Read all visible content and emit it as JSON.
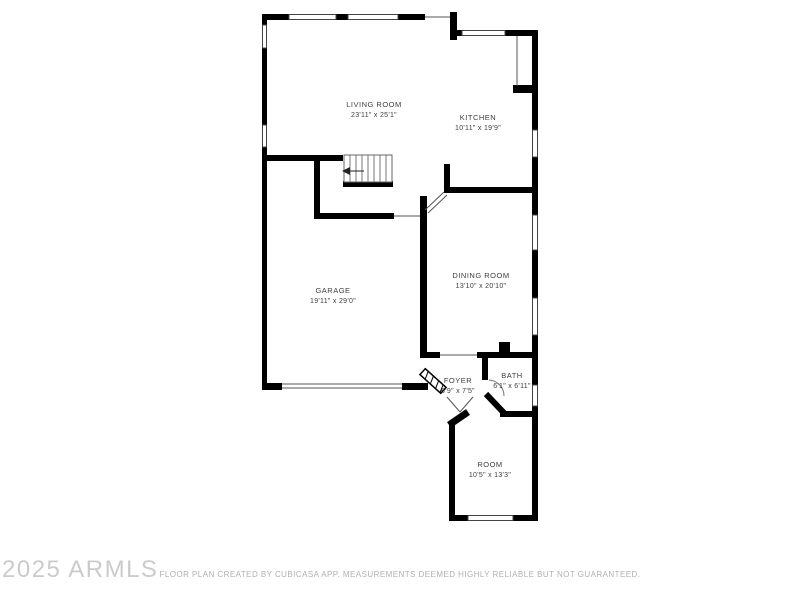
{
  "watermark": "2025 ARMLS",
  "disclaimer": "FLOOR PLAN CREATED BY CUBICASA APP. MEASUREMENTS DEEMED HIGHLY RELIABLE BUT NOT GUARANTEED.",
  "rooms": [
    {
      "name": "LIVING ROOM",
      "dimensions": "23'11\" x 25'1\""
    },
    {
      "name": "KITCHEN",
      "dimensions": "10'11\" x 19'9\""
    },
    {
      "name": "GARAGE",
      "dimensions": "19'11\" x 29'0\""
    },
    {
      "name": "DINING ROOM",
      "dimensions": "13'10\" x 20'10\""
    },
    {
      "name": "FOYER",
      "dimensions": "6'9\" x 7'5\""
    },
    {
      "name": "BATH",
      "dimensions": "6'1\" x 6'11\""
    },
    {
      "name": "ROOM",
      "dimensions": "10'5\" x 13'3\""
    }
  ],
  "colors": {
    "wall": "#000000",
    "background": "#ffffff",
    "label": "#3d3d3d",
    "watermark": "#cbcbcb",
    "disclaimer": "#b0b0b0"
  }
}
